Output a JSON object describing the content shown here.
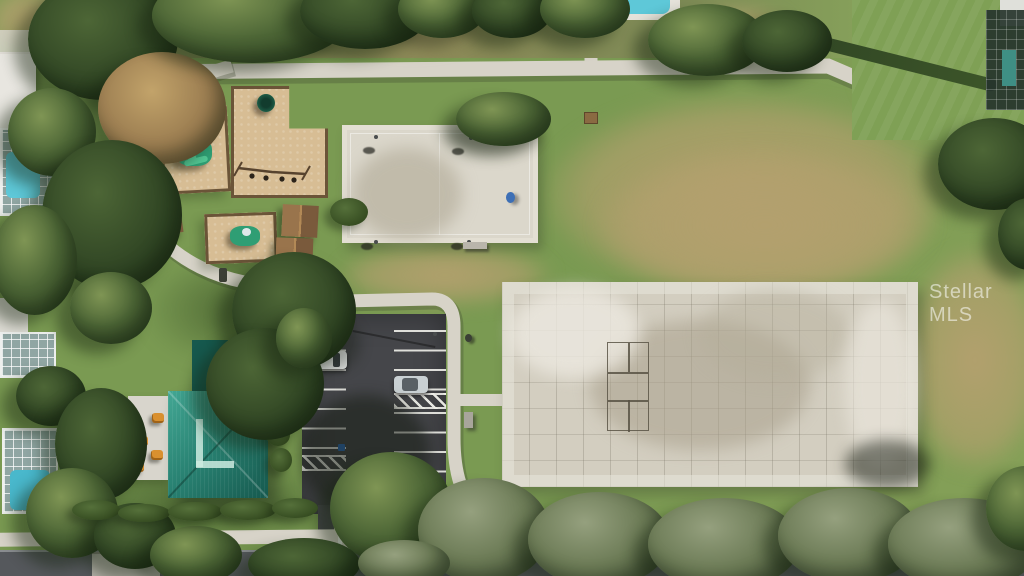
{
  "watermark": {
    "text": "Stellar MLS"
  },
  "scene": {
    "type": "aerial-drone-photograph",
    "subject": "community park with playgrounds, basketball court, large concrete multi-use pad, teal-roof picnic pavilion, parking lot, sidewalks, street and surrounding homes with screened pools"
  },
  "colors": {
    "grass": "#7a9a52",
    "grass-dry": "#b3a06e",
    "tree-light": "#7f9554",
    "tree-mid": "#4d6636",
    "tree-dark": "#2f4423",
    "sage-light": "#95a07e",
    "sage-mid": "#6b7a55",
    "sage-dark": "#46543a",
    "concrete": "#d7d3c8",
    "pad": "#d3cec0",
    "asphalt": "#45464a",
    "road": "#55585c",
    "mulch": "#d7bd94",
    "mulch-border": "#6b5438",
    "roof-light": "#43a794",
    "roof-mid": "#2a8474",
    "roof-dark": "#16594e",
    "pool": "#5ec8d8",
    "table-orange": "#d9902f",
    "handicap-blue": "#2f6db8",
    "car-white": "#eceeed",
    "car-silver": "#c9d0d3",
    "shelter-brown": "#7a5a3c",
    "shelter-brown-light": "#99744c",
    "playset-green": "#2f9e74",
    "playset-green-light": "#52c795"
  }
}
